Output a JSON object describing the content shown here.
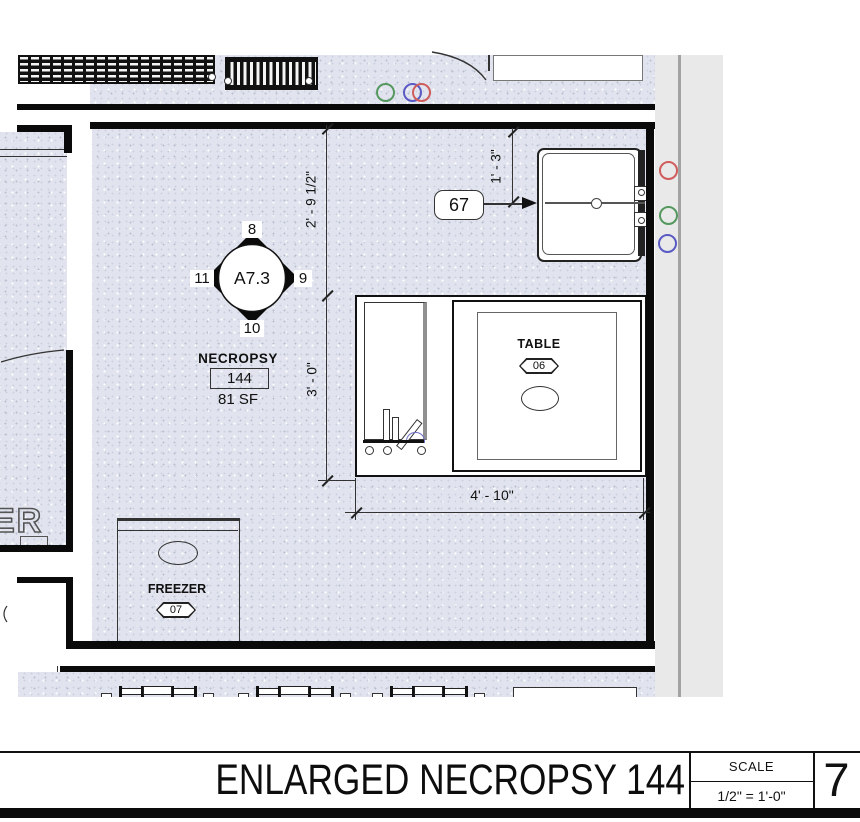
{
  "room": {
    "name": "NECROPSY",
    "number": "144",
    "area": "81 SF"
  },
  "detail_marker": {
    "sheet": "A7.3",
    "top": "8",
    "right": "9",
    "bottom": "10",
    "left": "11"
  },
  "equipment": {
    "tag_67": "67",
    "table": {
      "label": "TABLE",
      "tag": "06"
    },
    "freezer": {
      "label": "FREEZER",
      "tag": "07"
    }
  },
  "dimensions": {
    "wall_to_table": "2' - 9 1/2\"",
    "table_depth": "3' - 0\"",
    "sink_offset": "1' - 3\"",
    "table_width": "4' - 10\""
  },
  "adjacent_room_text": "ER",
  "title_block": {
    "title": "ENLARGED NECROPSY 144",
    "scale_label": "SCALE",
    "scale_value": "1/2\" = 1'-0\"",
    "sheet_number": "7"
  },
  "colors": {
    "stipple_bg": "#e1e4ee",
    "wall": "#0a0a0a",
    "page_strip": "#e9e9e9",
    "annotation_red": "#d05c5c",
    "annotation_green": "#55985f",
    "annotation_blue": "#5a5ac4"
  }
}
